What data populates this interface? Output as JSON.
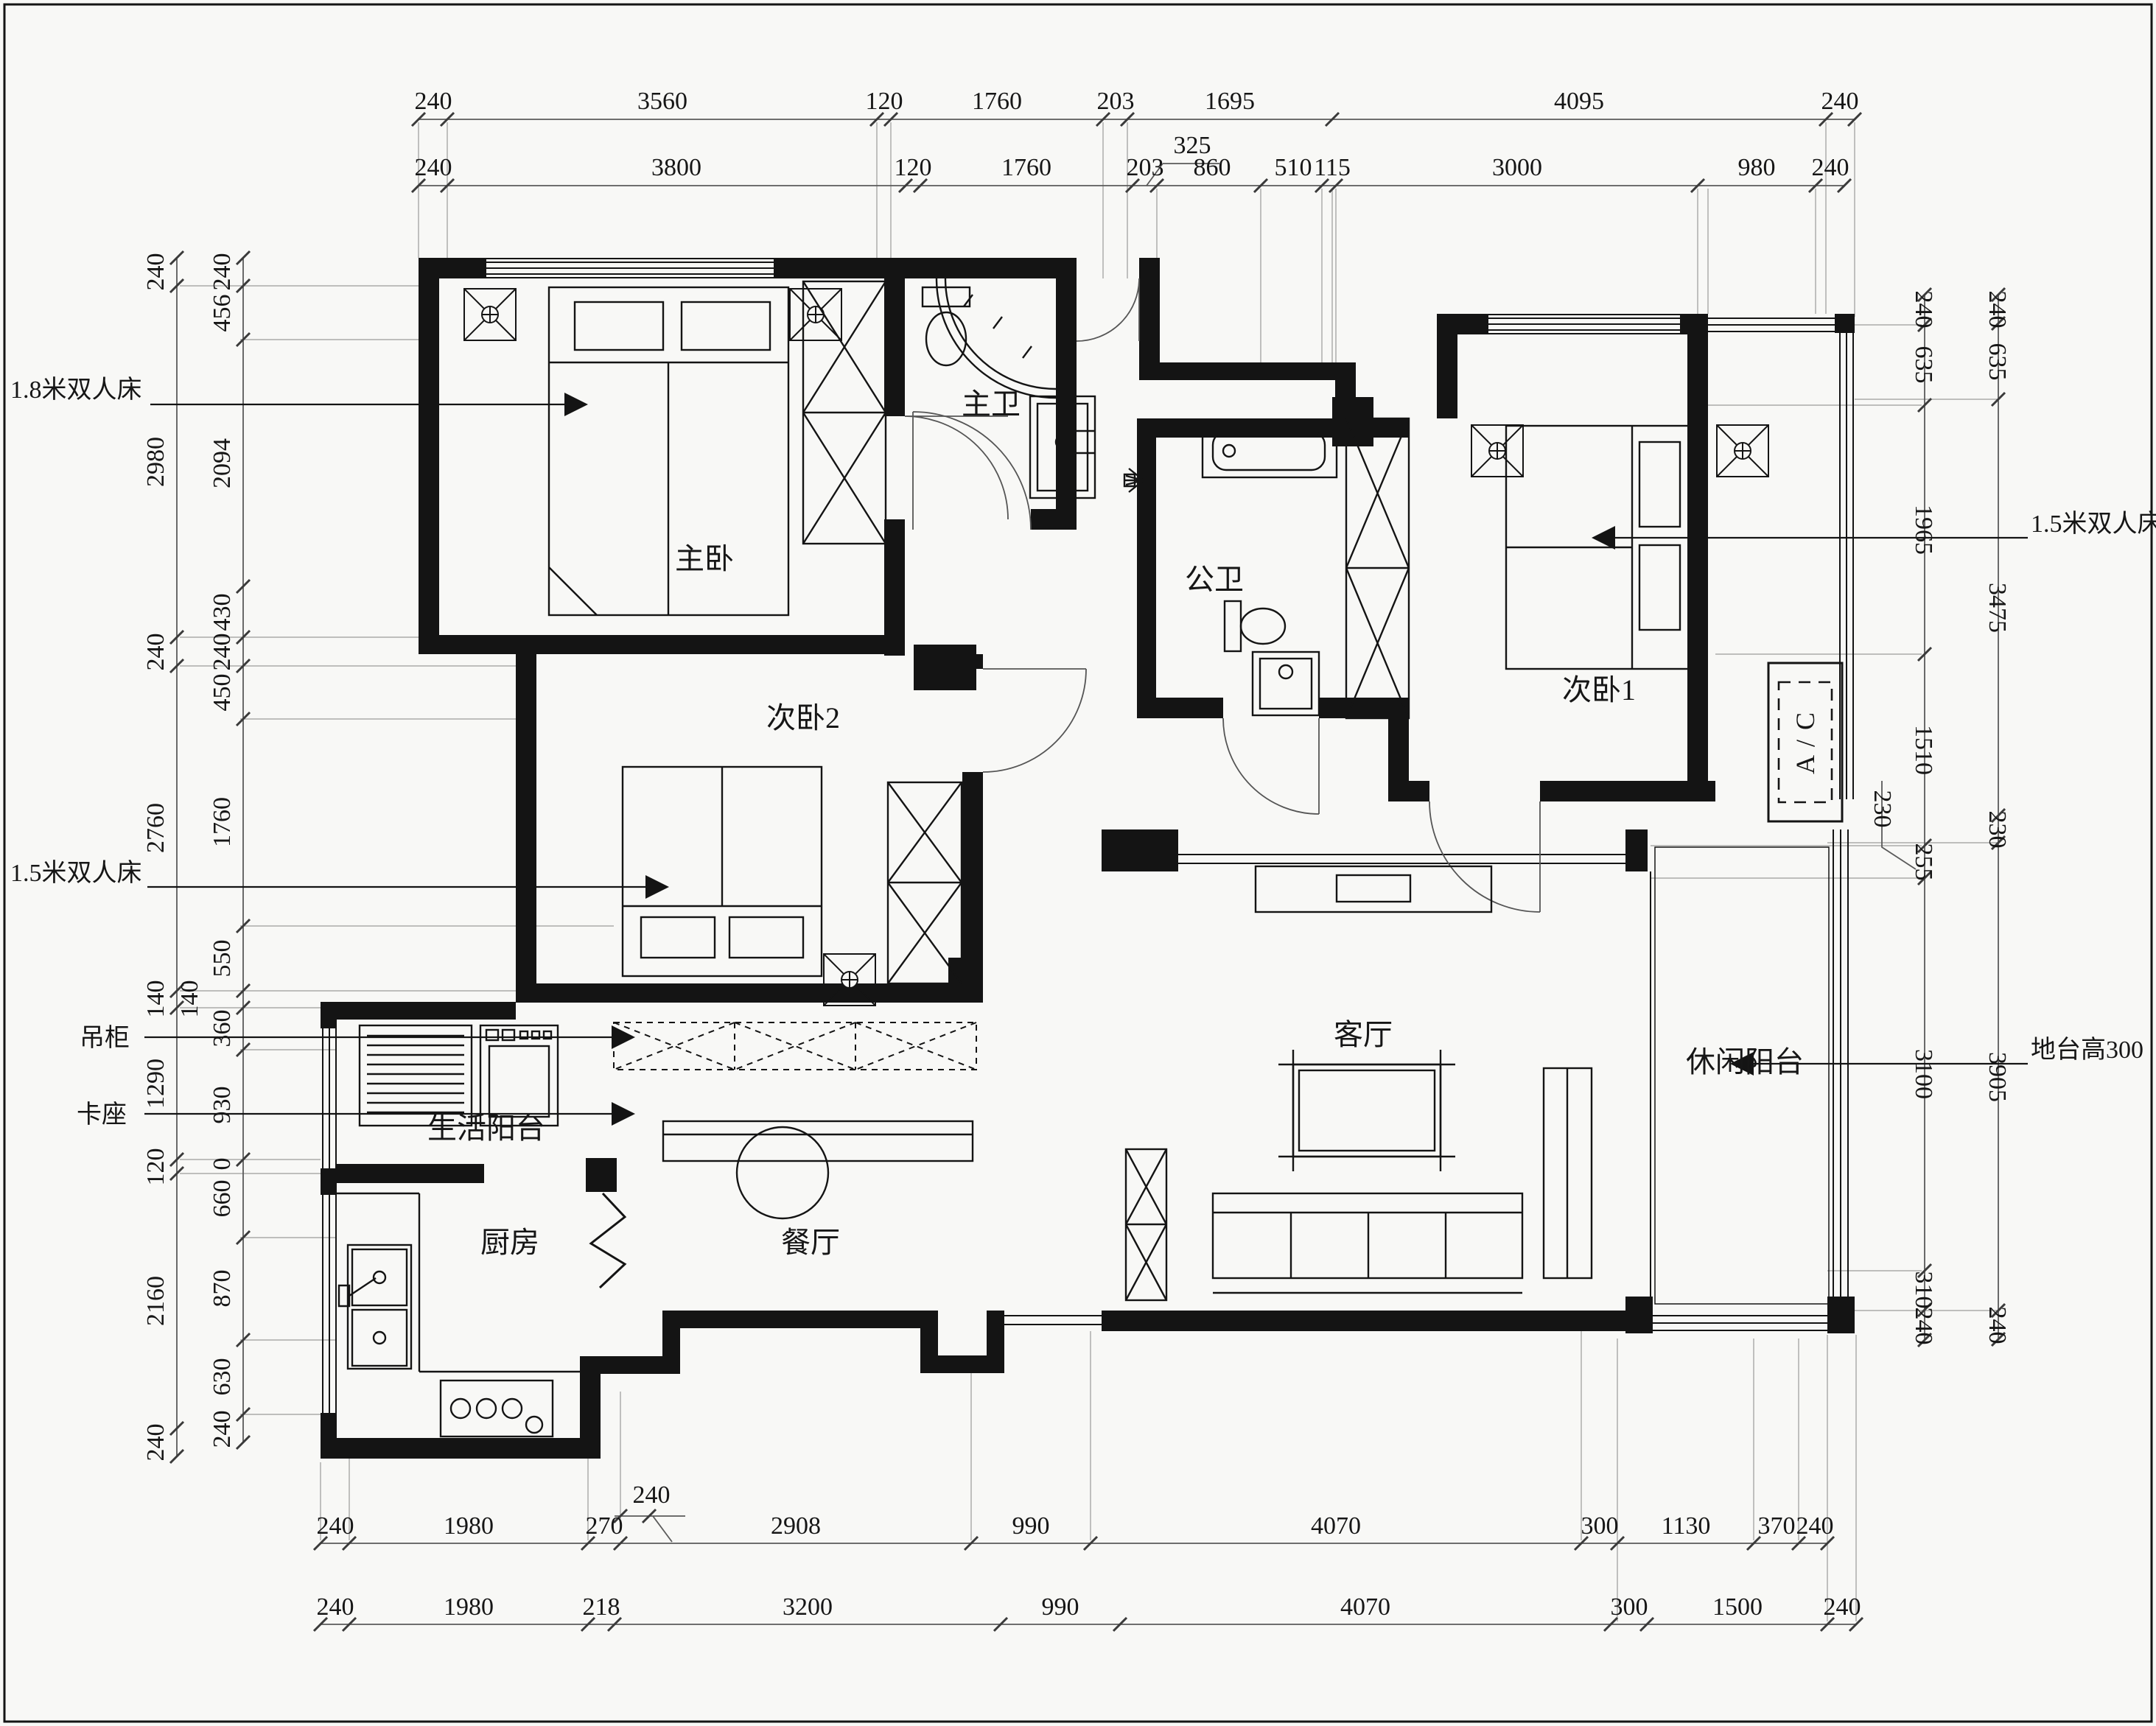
{
  "title": "apartment-floor-plan",
  "colors": {
    "background": "#f8f8f6",
    "line": "#141414",
    "dim_line": "#666666",
    "guide": "#999999"
  },
  "dimensions": {
    "top_row1": [
      "240",
      "3560",
      "120",
      "1760",
      "203",
      "1695",
      "4095",
      "240"
    ],
    "top_row2": [
      "240",
      "3800",
      "120",
      "1760",
      "203",
      "860",
      "510",
      "115",
      "3000",
      "980",
      "240"
    ],
    "top_offset_325": "325",
    "bottom_row1": [
      "240",
      "1980",
      "270",
      "2908",
      "990",
      "4070",
      "300",
      "1130",
      "370",
      "240"
    ],
    "bottom_offset_240": "240",
    "bottom_row2": [
      "240",
      "1980",
      "218",
      "3200",
      "990",
      "4070",
      "300",
      "1500",
      "240"
    ],
    "left_outer": [
      "240",
      "2980",
      "240",
      "2760",
      "140",
      "1290",
      "120",
      "2160",
      "240"
    ],
    "left_inner": [
      "240",
      "456",
      "2094",
      "430",
      "240",
      "450",
      "1760",
      "550",
      "360",
      "930",
      "0",
      "660",
      "870",
      "630",
      "240"
    ],
    "left_mid_140": "140",
    "right_inner": [
      "240",
      "635",
      "1965",
      "1510",
      "255",
      "3100",
      "310",
      "240"
    ],
    "right_outer": [
      "240",
      "635",
      "3475",
      "230",
      "3905",
      "240"
    ],
    "right_offset_230": "230"
  },
  "rooms": {
    "master_bedroom": "主卧",
    "master_bath": "主卫",
    "public_bath": "公卫",
    "bedroom1": "次卧1",
    "bedroom2": "次卧2",
    "living_room": "客厅",
    "leisure_balcony": "休闲阳台",
    "service_balcony": "生活阳台",
    "dining_room": "餐厅",
    "kitchen": "厨房"
  },
  "annotations": {
    "bed_18": "1.8米双人床",
    "bed_15_left": "1.5米双人床",
    "bed_15_right": "1.5米双人床",
    "hanging_cabinet": "吊柜",
    "booth_seat": "卡座",
    "platform_height": "地台高300",
    "ac_unit": "A / C"
  }
}
